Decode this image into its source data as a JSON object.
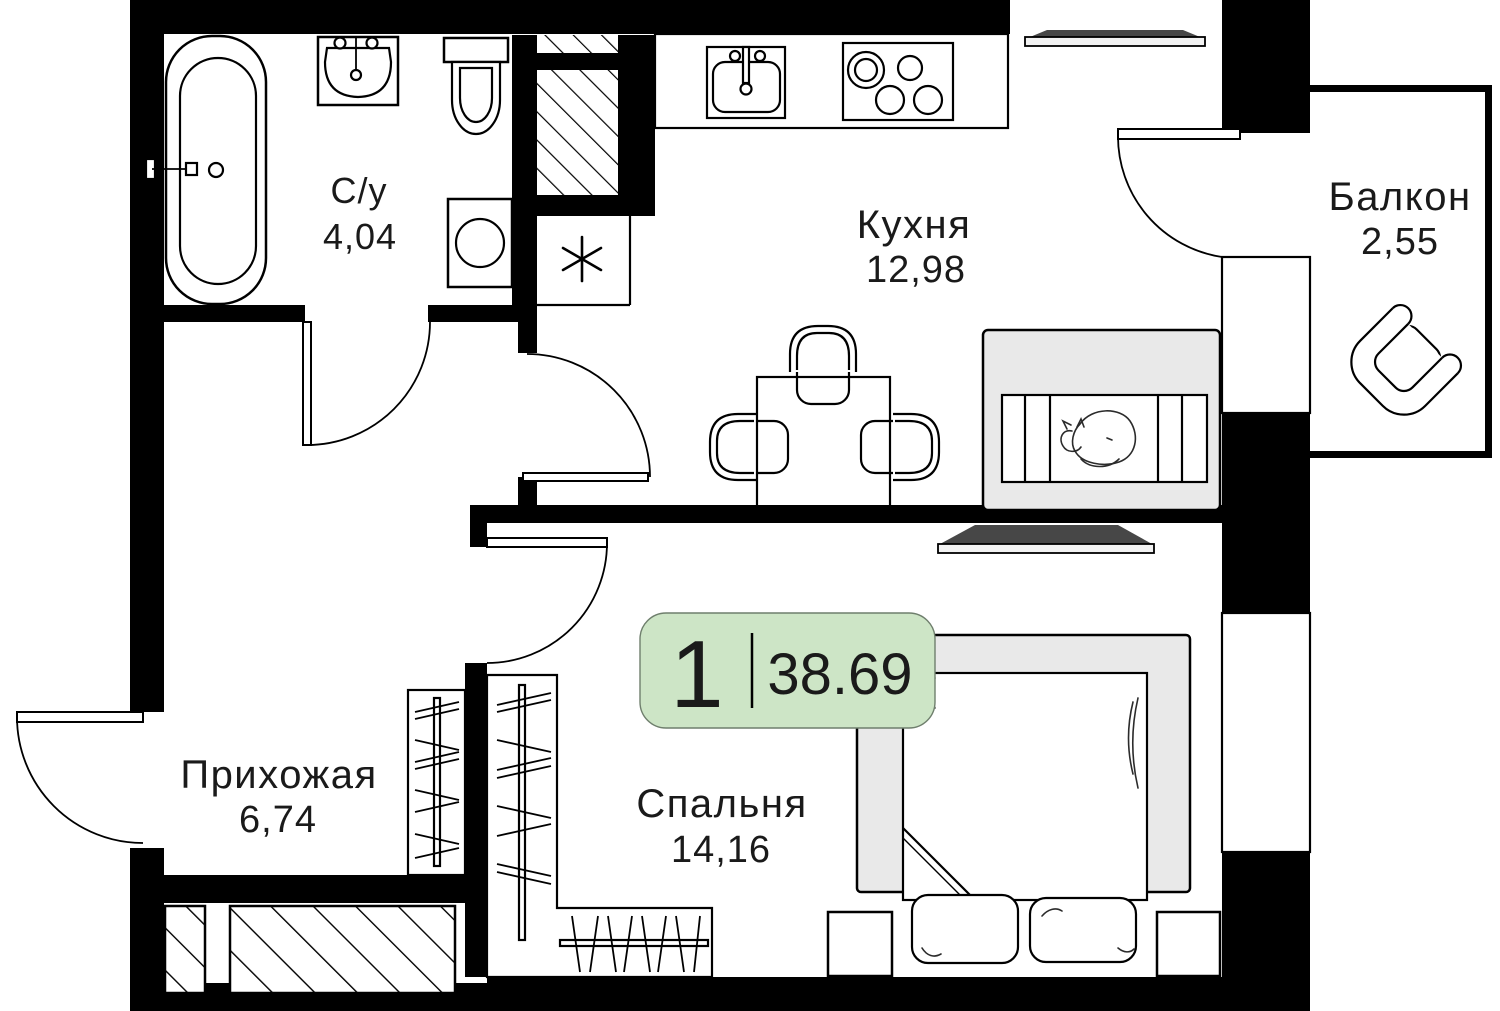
{
  "plan": {
    "badge": {
      "rooms_count": "1",
      "area_total": "38.69"
    },
    "rooms": [
      {
        "key": "bathroom",
        "name": "С/у",
        "area": "4,04"
      },
      {
        "key": "kitchen",
        "name": "Кухня",
        "area": "12,98"
      },
      {
        "key": "balcony",
        "name": "Балкон",
        "area": "2,55"
      },
      {
        "key": "hallway",
        "name": "Прихожая",
        "area": "6,74"
      },
      {
        "key": "bedroom",
        "name": "Спальня",
        "area": "14,16"
      }
    ]
  },
  "colors": {
    "wall": "#000000",
    "line": "#000000",
    "text": "#1a1a1a",
    "bg": "#ffffff",
    "badge-bg": "#cde5c6",
    "badge-border": "#6f7f6d",
    "furniture-gray": "#e9e9e9",
    "sill-gray": "#f2f2f2",
    "shadow-gray": "#474747"
  }
}
